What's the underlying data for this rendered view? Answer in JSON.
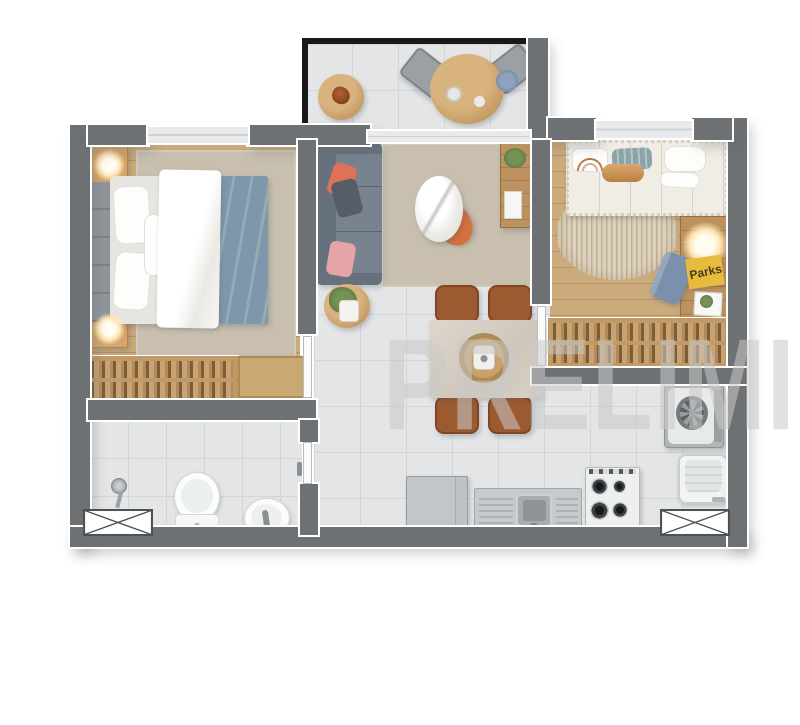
{
  "watermark": {
    "text": "PRELIMIN"
  },
  "signs": {
    "parks": "Parks"
  },
  "colors": {
    "wall": "#6e7173",
    "balconyWall": "#191919",
    "tile": "#e3e5e6",
    "tileLine": "#d3d6d7",
    "wood": "#cbaa7c",
    "woodLine": "#bb9263",
    "rug": "#c8bfae",
    "sofa": "#78838f",
    "sofaDark": "#67717d",
    "cushionOrange": "#dd7257",
    "cushionGray": "#565d66",
    "cushionPink": "#e5a5a6",
    "blanketBlue": "#7e97aa",
    "bedWhite": "#f0ede5",
    "headboard": "#8f969b",
    "wardrobeWood": "#c19a66",
    "clothesA": "#7d5c38",
    "clothesB": "#caa273",
    "marble": "#d8d0c6",
    "chairBrown": "#9c5a30",
    "accentOrange": "#d5703f",
    "applianceGray": "#b9bcbe",
    "steel": "#c6cacc",
    "fixtureWhite": "#f4f5f5",
    "lampGlow": "#ffca7a",
    "parksYellow": "#e9bb3d",
    "parksText": "#463a1c",
    "denim": "#7b90ad",
    "plant": "#5e7d4a",
    "tanWood": "#c49a62",
    "watermark": "#c9c9c9",
    "windowBand": "#e9eaeb"
  }
}
